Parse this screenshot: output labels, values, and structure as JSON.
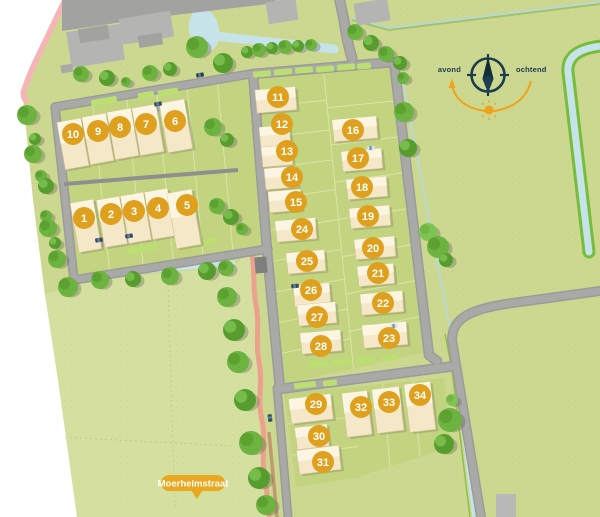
{
  "map": {
    "street_label": "Moerheimstraat",
    "compass": {
      "west_label": "avond",
      "east_label": "ochtend"
    },
    "lots": [
      {
        "number": "1",
        "x": 84,
        "y": 218
      },
      {
        "number": "2",
        "x": 111,
        "y": 214
      },
      {
        "number": "3",
        "x": 134,
        "y": 211
      },
      {
        "number": "4",
        "x": 158,
        "y": 208
      },
      {
        "number": "5",
        "x": 187,
        "y": 205
      },
      {
        "number": "6",
        "x": 175,
        "y": 121
      },
      {
        "number": "7",
        "x": 146,
        "y": 124
      },
      {
        "number": "8",
        "x": 120,
        "y": 127
      },
      {
        "number": "9",
        "x": 98,
        "y": 131
      },
      {
        "number": "10",
        "x": 73,
        "y": 134
      },
      {
        "number": "11",
        "x": 278,
        "y": 97
      },
      {
        "number": "12",
        "x": 282,
        "y": 124
      },
      {
        "number": "13",
        "x": 287,
        "y": 151
      },
      {
        "number": "14",
        "x": 292,
        "y": 177
      },
      {
        "number": "15",
        "x": 296,
        "y": 202
      },
      {
        "number": "16",
        "x": 353,
        "y": 130
      },
      {
        "number": "17",
        "x": 358,
        "y": 158
      },
      {
        "number": "18",
        "x": 362,
        "y": 187
      },
      {
        "number": "19",
        "x": 368,
        "y": 216
      },
      {
        "number": "20",
        "x": 373,
        "y": 248
      },
      {
        "number": "21",
        "x": 378,
        "y": 273
      },
      {
        "number": "22",
        "x": 383,
        "y": 303
      },
      {
        "number": "23",
        "x": 389,
        "y": 338
      },
      {
        "number": "24",
        "x": 302,
        "y": 229
      },
      {
        "number": "25",
        "x": 307,
        "y": 261
      },
      {
        "number": "26",
        "x": 311,
        "y": 290
      },
      {
        "number": "27",
        "x": 317,
        "y": 317
      },
      {
        "number": "28",
        "x": 321,
        "y": 346
      },
      {
        "number": "29",
        "x": 316,
        "y": 404
      },
      {
        "number": "30",
        "x": 319,
        "y": 436
      },
      {
        "number": "31",
        "x": 323,
        "y": 462
      },
      {
        "number": "32",
        "x": 361,
        "y": 407
      },
      {
        "number": "33",
        "x": 389,
        "y": 402
      },
      {
        "number": "34",
        "x": 420,
        "y": 395
      }
    ],
    "colors": {
      "lot_marker": "#dfa01e",
      "label_pill": "#e9a81f",
      "compass_navy": "#1d3c50",
      "compass_orange": "#efa31a",
      "water": "#c6e3e9",
      "road": "#a0a09e",
      "grass": "#ccd88f",
      "tree": "#6cb340",
      "house": "#f4e8c8",
      "path_pink": "#eba18d"
    }
  }
}
